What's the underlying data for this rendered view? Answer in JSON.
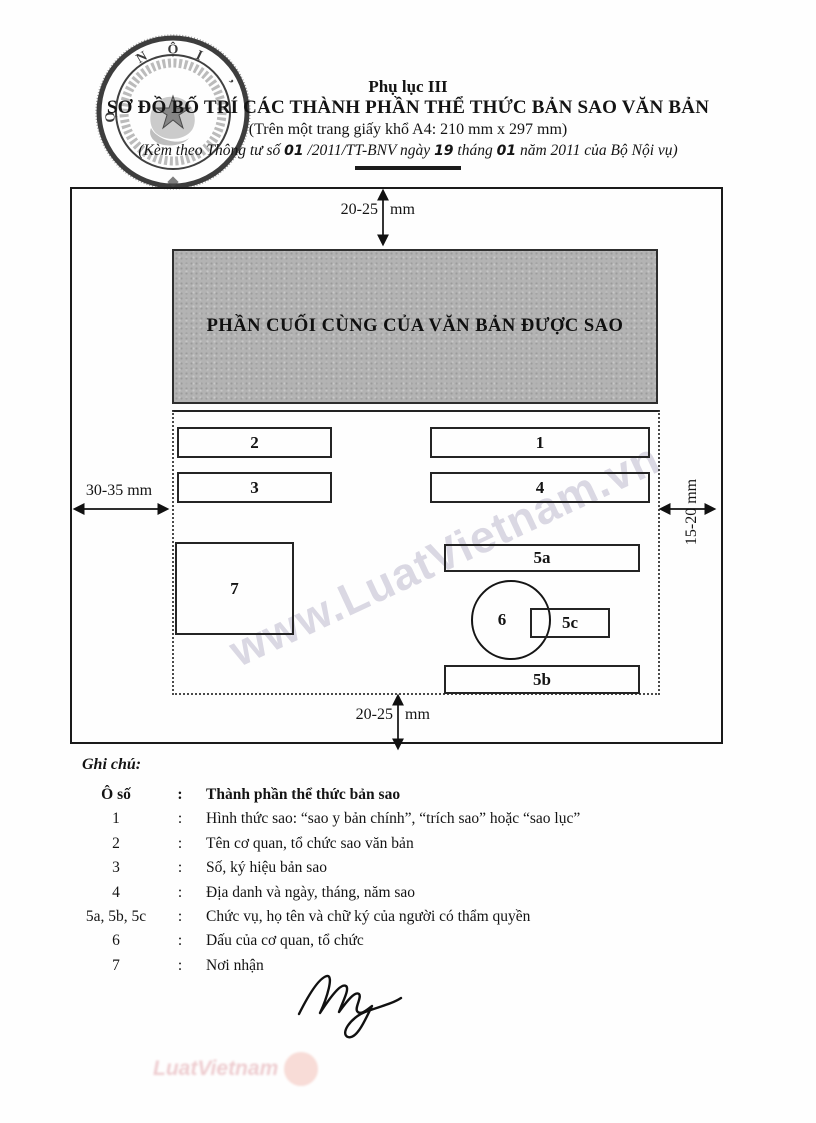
{
  "header": {
    "appendix": "Phụ lục III",
    "title": "SƠ ĐỒ BỐ TRÍ CÁC THÀNH PHẦN THỂ THỨC BẢN SAO VĂN BẢN",
    "paper_note": "(Trên một trang giấy khổ A4: 210 mm x 297 mm)",
    "issuance_parts": [
      "(Kèm theo Thông tư số ",
      "01",
      " /2011/TT-BNV ngày ",
      "19",
      " tháng ",
      "01",
      " năm 2011 của Bộ Nội vụ)"
    ]
  },
  "stamp": {
    "letters": {
      "top_left": "N",
      "top": "Ộ",
      "top_right": "I",
      "left": "Ọ",
      "right_mark": "’"
    }
  },
  "diagram": {
    "shaded_label": "PHẦN CUỐI CÙNG CỦA VĂN BẢN ĐƯỢC SAO",
    "margins": {
      "top_value": "20-25",
      "top_unit": "mm",
      "bottom_value": "20-25",
      "bottom_unit": "mm",
      "left_label": "30-35 mm",
      "right_label": "15-20 mm"
    },
    "boxes": {
      "b1": "1",
      "b2": "2",
      "b3": "3",
      "b4": "4",
      "b5a": "5a",
      "b5b": "5b",
      "b5c": "5c",
      "b6": "6",
      "b7": "7"
    }
  },
  "watermark_text": "www.LuatVietnam.vn",
  "legend": {
    "heading": "Ghi chú:",
    "separator": ":",
    "header_label": "Ô số",
    "header_description": "Thành phần thể thức bản sao",
    "rows": [
      {
        "label": "1",
        "description": "Hình thức sao: “sao y bản chính”, “trích sao” hoặc “sao lục”"
      },
      {
        "label": "2",
        "description": "Tên cơ quan, tổ chức sao văn bản"
      },
      {
        "label": "3",
        "description": "Số, ký hiệu bản sao"
      },
      {
        "label": "4",
        "description": "Địa danh và ngày, tháng, năm sao"
      },
      {
        "label": "5a, 5b, 5c",
        "description": "Chức vụ, họ tên và chữ ký của người có thẩm quyền"
      },
      {
        "label": "6",
        "description": "Dấu của cơ quan, tổ chức"
      },
      {
        "label": "7",
        "description": "Nơi nhận"
      }
    ]
  },
  "footer_brand": {
    "text": "LuatVietnam"
  },
  "colors": {
    "ink": "#141414",
    "shaded_fill": "#b3b3b3",
    "watermark": "#b0abc4",
    "brand_pink": "#c85a64"
  }
}
